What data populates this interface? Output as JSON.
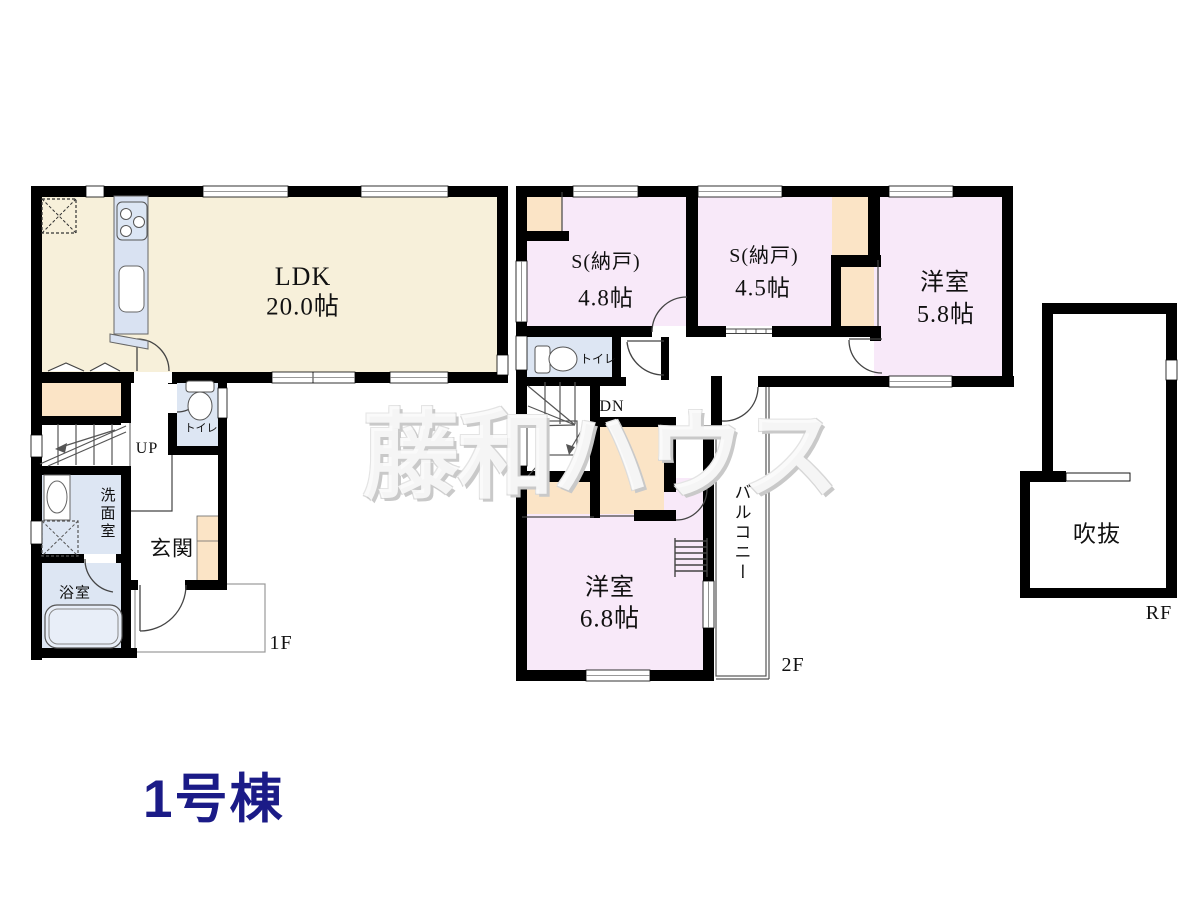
{
  "building_label": "1号棟",
  "watermark": "藤和ハウス",
  "floor1": {
    "label": "1F",
    "ldk": {
      "name": "LDK",
      "size": "20.0帖"
    },
    "entrance": "玄関",
    "washroom": "洗面室",
    "bathroom": "浴室",
    "toilet": "トイレ",
    "stairs": "UP"
  },
  "floor2": {
    "label": "2F",
    "storage_a": {
      "name": "S(納戸)",
      "size": "4.8帖"
    },
    "storage_b": {
      "name": "S(納戸)",
      "size": "4.5帖"
    },
    "western_a": {
      "name": "洋室",
      "size": "5.8帖"
    },
    "western_b": {
      "name": "洋室",
      "size": "6.8帖"
    },
    "toilet": "トイレ",
    "balcony": "バルコニー",
    "stairs": "DN"
  },
  "roof": {
    "label": "RF",
    "void_space": "吹抜"
  },
  "colors": {
    "wall": "#000000",
    "ldk_floor": "#f7f0da",
    "room_pink": "#f8e9f9",
    "closet_orange": "#fbe4c6",
    "sanitary_blue": "#dde6f3",
    "kitchen_blue": "#d9e2f2",
    "title_navy": "#1b1b87"
  }
}
